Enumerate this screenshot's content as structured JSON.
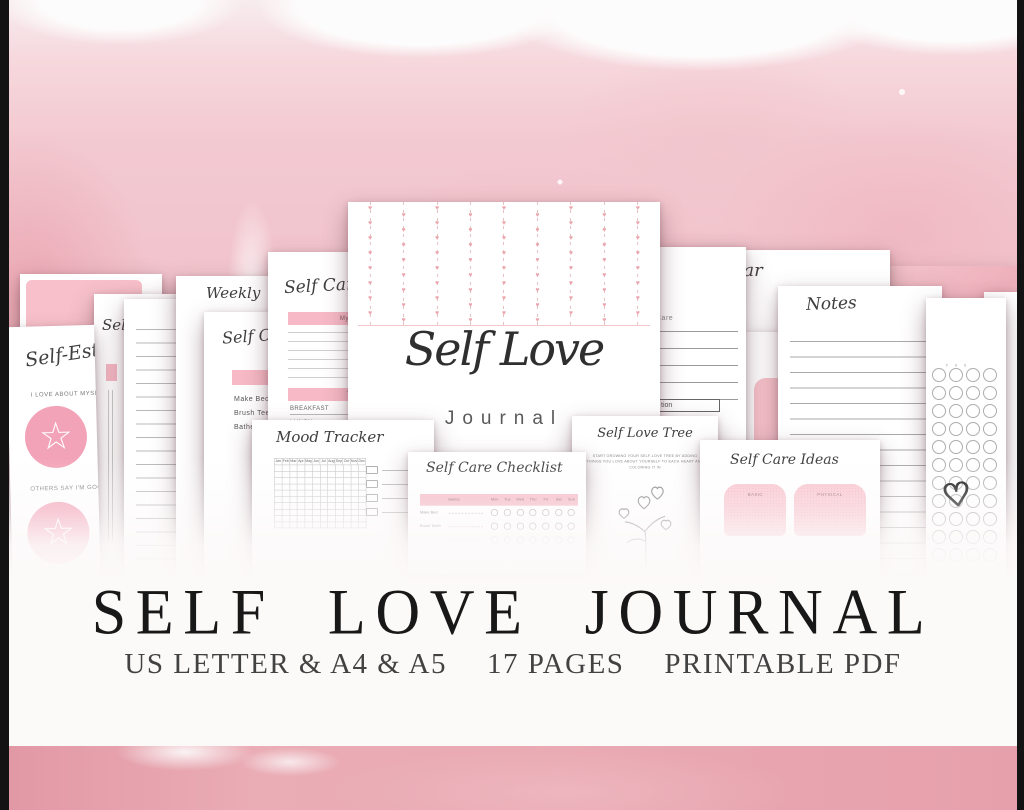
{
  "colors": {
    "accent-pink": "#f6b9c5",
    "accent-pink-strong": "#f3a3b8",
    "watercolor-light": "#f6d8dd",
    "watercolor-mid": "#f1c3cc",
    "watercolor-deep": "#e8a3ae",
    "band-bottom": "#e9a9b2",
    "ink": "#181818",
    "script-ink": "#3f3f3f"
  },
  "banner": {
    "title": "SELF LOVE JOURNAL",
    "specs": [
      "US LETTER & A4 & A5",
      "17 PAGES",
      "PRINTABLE PDF"
    ]
  },
  "cover": {
    "title": "Self Love",
    "subtitle": "Journal"
  },
  "pages": {
    "self_esteem": {
      "title": "Self-Esteem",
      "label_love": "I LOVE ABOUT MYSELF",
      "label_others": "OTHERS SAY I'M GOOD AT",
      "star_icon": "☆"
    },
    "self_tab": {
      "title": "Self"
    },
    "weekly": {
      "title": "Weekly"
    },
    "morning_routine": {
      "title": "Self Care",
      "items": [
        "Make Bed",
        "Brush Teeth",
        "Bathe"
      ]
    },
    "daily": {
      "title": "Self Care",
      "morning_header": "My Morning",
      "today_header": "TODAY",
      "meals": [
        "BREAKFAST",
        "LUNCH",
        "DINNER"
      ]
    },
    "calendar": {
      "title": "Calendar"
    },
    "care_notes": {
      "label": "Care",
      "box_label": "tion"
    },
    "notes": {
      "title": "Notes"
    },
    "habit_circles": {
      "day_letters": [
        "F",
        "S",
        "S"
      ],
      "heart_doodle": "♡"
    },
    "mood_tracker": {
      "title": "Mood Tracker",
      "months": [
        "Jan",
        "Feb",
        "Mar",
        "Apr",
        "May",
        "Jun",
        "Jul",
        "Aug",
        "Sep",
        "Oct",
        "Nov",
        "Dec"
      ]
    },
    "checklist": {
      "title": "Self Care Checklist",
      "basics_header": "Basics",
      "days": [
        "Mon",
        "Tue",
        "Wed",
        "Thu",
        "Fri",
        "Sat",
        "Sun"
      ],
      "rows": [
        "Make Bed",
        "Brush Teeth"
      ]
    },
    "tree": {
      "title": "Self Love Tree",
      "instructions": "START GROWING YOUR SELF-LOVE TREE BY ADDING THINGS YOU LOVE ABOUT YOURSELF TO EACH HEART AND COLORING IT IN"
    },
    "ideas": {
      "title": "Self Care Ideas",
      "categories": [
        "BASIC",
        "PHYSICAL"
      ]
    }
  }
}
